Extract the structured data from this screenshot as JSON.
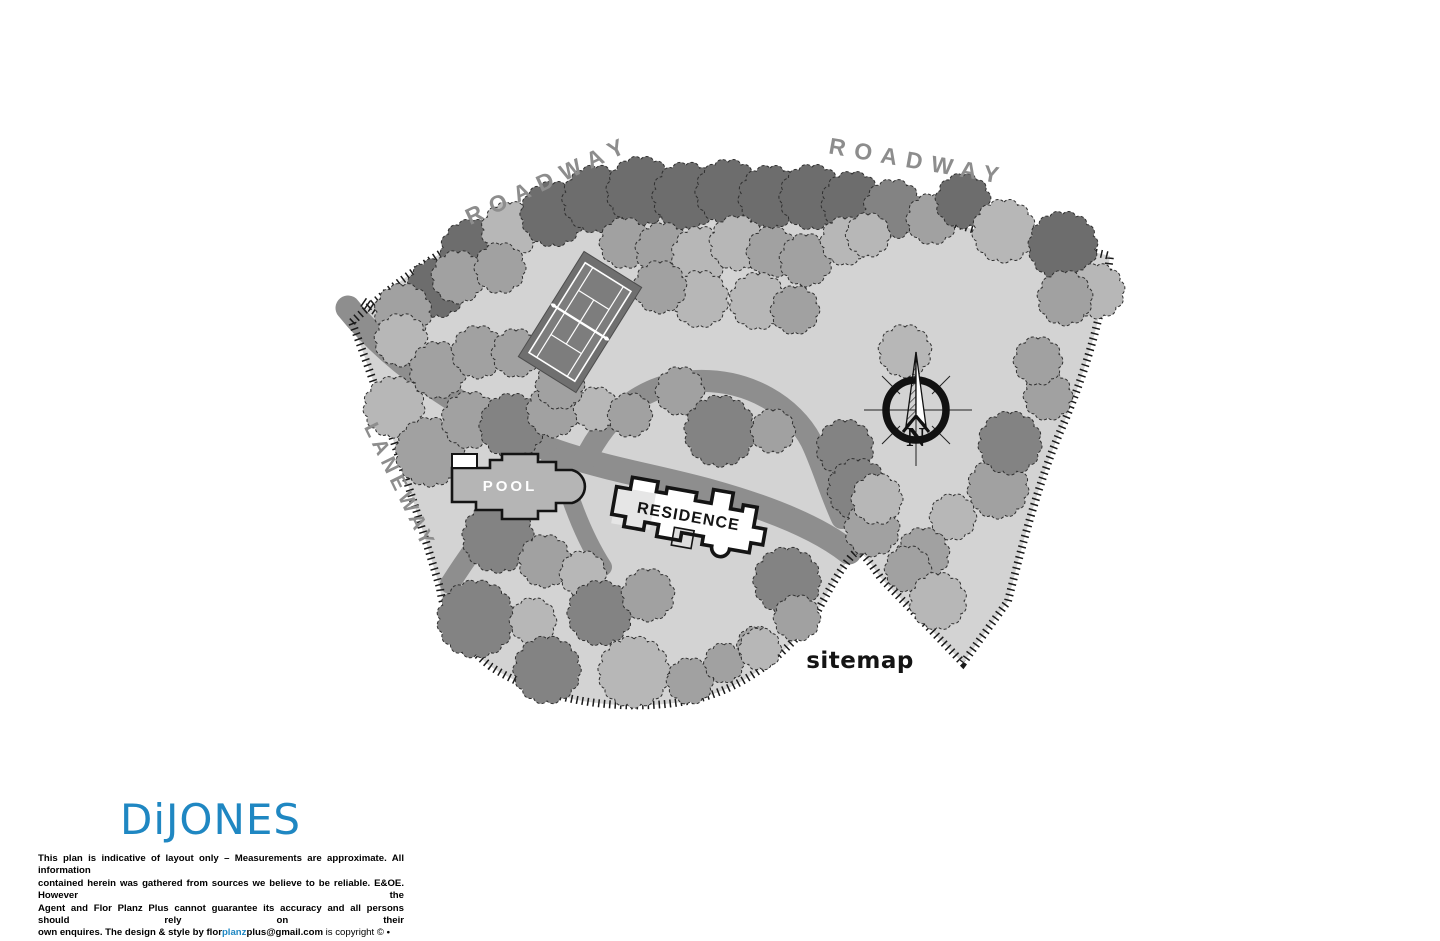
{
  "plan": {
    "labels": {
      "roadway_left": "ROADWAY",
      "roadway_right": "ROADWAY",
      "laneway": "LANEWAY",
      "pool": "POOL",
      "residence": "RESIDENCE",
      "sitemap": "sitemap",
      "compass_north": "N"
    },
    "colors": {
      "site": "#d3d3d3",
      "driveway": "#8e8e8e",
      "boundary_tick": "#1a1a1a",
      "tree_outline": "#2f2f2f",
      "tree_shades": [
        "#b7b7b7",
        "#a1a1a1",
        "#838383",
        "#6d6d6d"
      ],
      "court_surround": "#6f6f6f",
      "court_inner": "#7d7d7d",
      "court_lines": "#ffffff",
      "pool_fill": "#b5b5b5",
      "residence_wing": "#e6e6e6",
      "label_gray": "#8d8d8d",
      "logo_blue": "#1f87c2",
      "muted_gray": "#9a9a9a"
    },
    "site_outline": "M352,322 C420,258 505,212 565,193 C645,167 705,178 762,179 C832,181 902,206 962,226 C1012,242 1072,246 1110,256 C1102,320 1082,382 1060,432 C1040,478 1022,545 1008,601 L963,663 L880,577 C872,565 864,554 858,551 C851,554 838,572 815,616 C780,661 738,691 688,701 C618,713 540,700 490,666 C459,641 443,614 440,588 C420,520 388,420 352,322 Z",
    "extra_ticks": [
      "M363,302 L385,317"
    ],
    "driveways": [
      {
        "d": "M348,308 C372,338 402,364 440,390 C482,418 522,441 566,455 C616,471 662,478 712,492 C762,506 816,526 849,552",
        "w": 25
      },
      {
        "d": "M585,460 C608,412 646,383 696,381 C750,379 793,407 811,441 C821,461 830,492 842,518",
        "w": 22
      },
      {
        "d": "M562,457 C526,480 487,526 450,584",
        "w": 20
      },
      {
        "d": "M560,464 C571,504 585,539 603,567",
        "w": 18
      }
    ],
    "trees": [
      [
        437,
        288,
        27,
        3
      ],
      [
        472,
        251,
        29,
        3
      ],
      [
        510,
        230,
        26,
        0
      ],
      [
        553,
        214,
        30,
        3
      ],
      [
        596,
        199,
        31,
        3
      ],
      [
        641,
        191,
        32,
        3
      ],
      [
        686,
        196,
        31,
        3
      ],
      [
        728,
        192,
        30,
        3
      ],
      [
        770,
        197,
        29,
        3
      ],
      [
        812,
        197,
        30,
        3
      ],
      [
        852,
        202,
        28,
        3
      ],
      [
        893,
        209,
        27,
        2
      ],
      [
        932,
        219,
        23,
        1
      ],
      [
        963,
        201,
        25,
        3
      ],
      [
        1004,
        231,
        29,
        0
      ],
      [
        1063,
        246,
        32,
        3
      ],
      [
        1097,
        291,
        25,
        0
      ],
      [
        458,
        277,
        24,
        1
      ],
      [
        500,
        268,
        23,
        1
      ],
      [
        625,
        243,
        23,
        1
      ],
      [
        663,
        250,
        25,
        1
      ],
      [
        700,
        255,
        26,
        0
      ],
      [
        737,
        243,
        25,
        0
      ],
      [
        772,
        252,
        23,
        1
      ],
      [
        806,
        260,
        24,
        1
      ],
      [
        845,
        241,
        22,
        0
      ],
      [
        868,
        235,
        20,
        0
      ],
      [
        758,
        301,
        26,
        0
      ],
      [
        795,
        310,
        22,
        1
      ],
      [
        700,
        299,
        26,
        0
      ],
      [
        660,
        287,
        24,
        1
      ],
      [
        905,
        351,
        24,
        0
      ],
      [
        403,
        312,
        26,
        1
      ],
      [
        401,
        340,
        24,
        0
      ],
      [
        394,
        407,
        28,
        0
      ],
      [
        438,
        370,
        26,
        1
      ],
      [
        478,
        352,
        24,
        1
      ],
      [
        516,
        353,
        22,
        1
      ],
      [
        430,
        452,
        32,
        1
      ],
      [
        470,
        420,
        26,
        1
      ],
      [
        512,
        426,
        30,
        2
      ],
      [
        553,
        411,
        24,
        1
      ],
      [
        596,
        409,
        20,
        0
      ],
      [
        630,
        415,
        20,
        1
      ],
      [
        560,
        385,
        22,
        1
      ],
      [
        498,
        537,
        33,
        2
      ],
      [
        545,
        561,
        24,
        1
      ],
      [
        583,
        574,
        21,
        0
      ],
      [
        680,
        391,
        22,
        1
      ],
      [
        720,
        431,
        33,
        2
      ],
      [
        773,
        431,
        20,
        1
      ],
      [
        845,
        448,
        26,
        2
      ],
      [
        858,
        489,
        28,
        2
      ],
      [
        476,
        619,
        36,
        2
      ],
      [
        533,
        621,
        21,
        0
      ],
      [
        547,
        670,
        31,
        2
      ],
      [
        600,
        613,
        30,
        2
      ],
      [
        648,
        595,
        24,
        1
      ],
      [
        634,
        672,
        33,
        0
      ],
      [
        690,
        681,
        21,
        1
      ],
      [
        724,
        663,
        18,
        1
      ],
      [
        756,
        645,
        17,
        1
      ],
      [
        787,
        581,
        31,
        2
      ],
      [
        797,
        618,
        21,
        1
      ],
      [
        760,
        649,
        19,
        0
      ],
      [
        998,
        488,
        28,
        1
      ],
      [
        953,
        517,
        21,
        0
      ],
      [
        923,
        554,
        24,
        1
      ],
      [
        1010,
        443,
        29,
        2
      ],
      [
        1048,
        396,
        22,
        1
      ],
      [
        1038,
        361,
        22,
        1
      ],
      [
        1065,
        298,
        25,
        1
      ],
      [
        872,
        529,
        25,
        1
      ],
      [
        877,
        499,
        23,
        0
      ],
      [
        908,
        569,
        21,
        1
      ],
      [
        938,
        601,
        26,
        0
      ]
    ]
  },
  "branding": {
    "logo": "DiJONES"
  },
  "disclaimer": {
    "line1": "This plan is indicative of layout only – Measurements are approximate. All information",
    "line2": "contained herein was gathered from sources we believe to be reliable. E&OE. However the",
    "line3": "Agent and Flor Planz Plus cannot guarantee its accuracy and all persons should rely on their",
    "line4_prefix": "own enquires. The design & style by ",
    "line4_flor": "flor",
    "line4_planz": "planz",
    "line4_plus": "plus@gmail.com",
    "line4_mid": " is copyright © ",
    "line4_bullet": "•",
    "line4_code": " 0406 2020"
  }
}
